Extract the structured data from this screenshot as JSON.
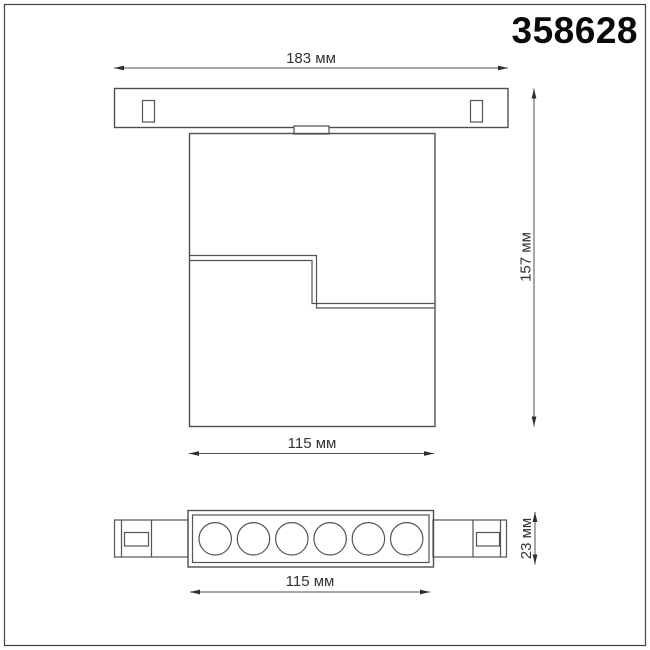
{
  "header": {
    "model_number": "358628"
  },
  "drawing": {
    "unit": "мм",
    "line_color": "#4f4f4f",
    "text_color": "#333333",
    "top_view": {
      "description": "front view of track-mounted luminaire: mounting track with two slots, small adapter, stepped rectangular body",
      "dim_track_width": "183 мм",
      "dim_track_width_value": 183,
      "dim_overall_height": "157 мм",
      "dim_overall_height_value": 157,
      "dim_body_width": "115 мм",
      "dim_body_width_value": 115
    },
    "bottom_view": {
      "description": "bottom view of luminaire: LED strip with six round lenses and side track connectors",
      "led_count": 6,
      "dim_width": "115 мм",
      "dim_width_value": 115,
      "dim_depth": "23 мм",
      "dim_depth_value": 23
    }
  }
}
